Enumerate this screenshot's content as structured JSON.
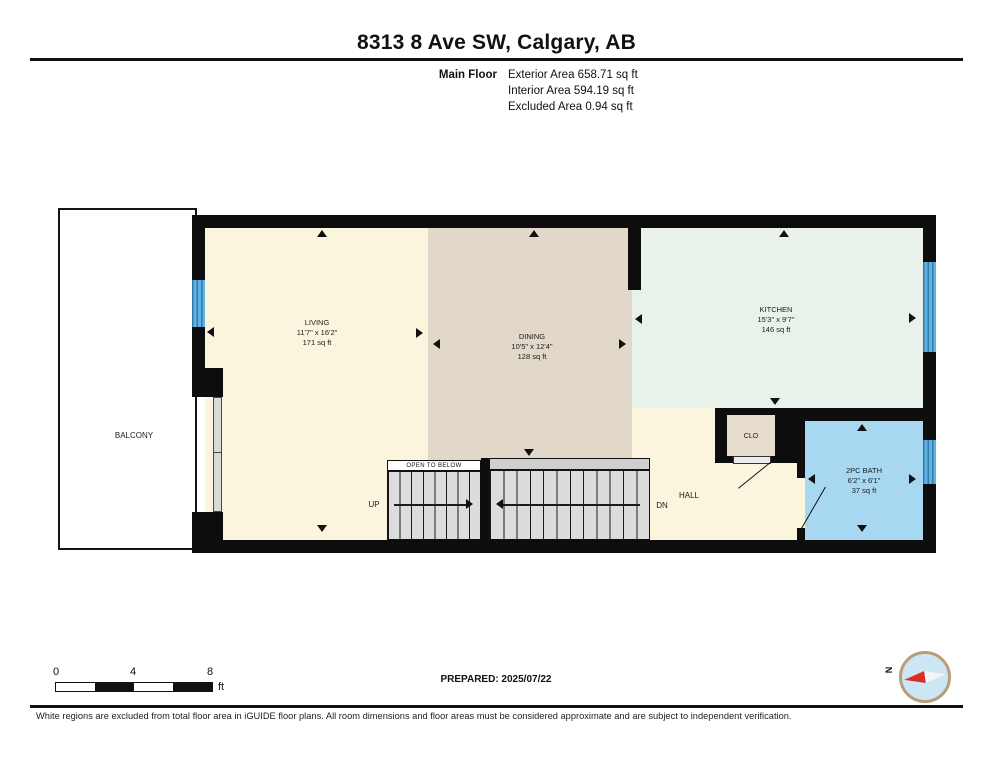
{
  "header": {
    "title": "8313 8 Ave SW, Calgary, AB",
    "floor_label": "Main Floor",
    "area_lines": [
      "Exterior Area 658.71 sq ft",
      "Interior Area 594.19 sq ft",
      "Excluded Area 0.94 sq ft"
    ]
  },
  "plan": {
    "rooms": [
      {
        "name": "LIVING",
        "dims": "11'7\" x 16'2\"",
        "area": "171 sq ft"
      },
      {
        "name": "DINING",
        "dims": "10'5\" x 12'4\"",
        "area": "128 sq ft"
      },
      {
        "name": "KITCHEN",
        "dims": "15'3\" x 9'7\"",
        "area": "146 sq ft"
      },
      {
        "name": "2PC BATH",
        "dims": "6'2\" x 6'1\"",
        "area": "37 sq ft"
      }
    ],
    "balcony_label": "BALCONY",
    "closet_label": "CLO",
    "hall_label": "HALL",
    "up_label": "UP",
    "dn_label": "DN",
    "open_to_below_label": "OPEN TO BELOW"
  },
  "footer": {
    "scale_ticks": [
      "0",
      "4",
      "8"
    ],
    "scale_unit": "ft",
    "prepared": "PREPARED: 2025/07/22",
    "compass_north": "N",
    "disclaimer": "White regions are excluded from total floor area in iGUIDE floor plans. All room dimensions and floor areas must be considered approximate and are subject to independent verification."
  },
  "colors": {
    "wall": "#0d0d0d",
    "living": "#fbf5de",
    "dining": "#e2d8c9",
    "kitchen": "#e9f1eb",
    "bath": "#a8d8f1",
    "closet": "#e6dccc",
    "stairs": "#dcdcdc",
    "window": "#4da3d6",
    "compass_ring": "#b99c78",
    "compass_fill": "#cde6f4",
    "compass_needle": "#d93025"
  }
}
